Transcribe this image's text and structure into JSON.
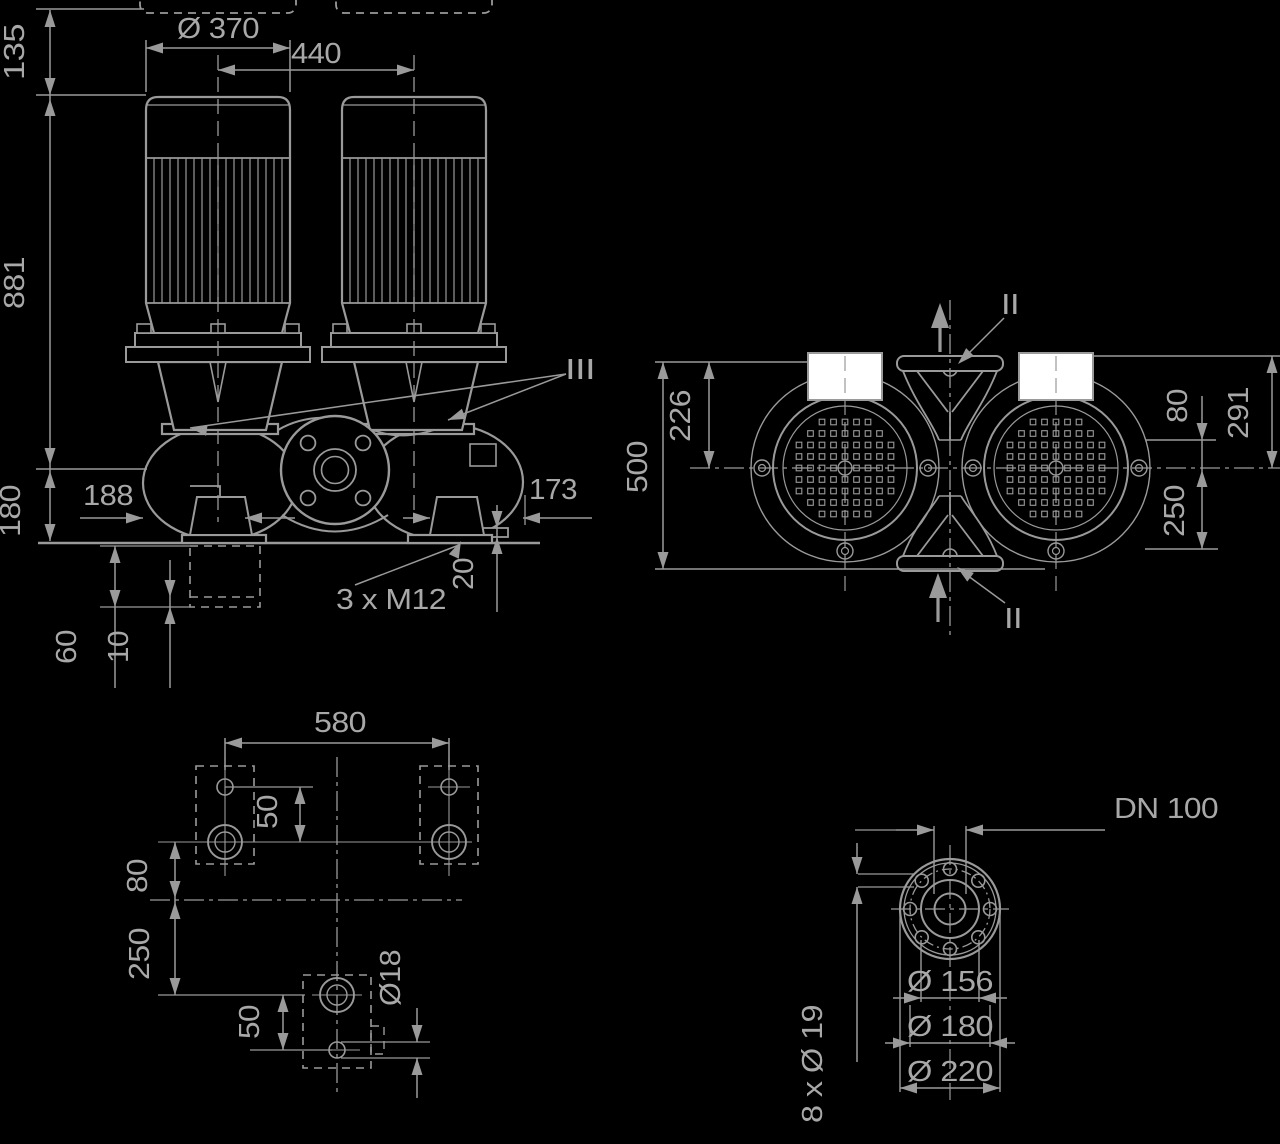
{
  "drawing": {
    "type": "pump-dimensional-drawing",
    "colors": {
      "background": "#000000",
      "line": "#9a9a9a",
      "text": "#a8a8a8",
      "white_fill": "#ffffff"
    },
    "views": {
      "front": {
        "labels": {
          "height_135": "135",
          "motor_dia_370": "Ø 370",
          "motor_spacing_440": "440",
          "height_881": "881",
          "height_180": "180",
          "offset_188": "188",
          "offset_173": "173",
          "pad_20": "20",
          "anchor_bolts": "3 x M12",
          "grout_60": "60",
          "grout_10": "10",
          "section_mark_iii": "III"
        }
      },
      "top": {
        "labels": {
          "depth_500": "500",
          "depth_226": "226",
          "pipe_80": "80",
          "depth_291": "291",
          "depth_250": "250",
          "section_mark_ii_top": "II",
          "section_mark_ii_bottom": "II"
        }
      },
      "foundation": {
        "labels": {
          "span_580": "580",
          "hole_offset_50_top": "50",
          "offset_80": "80",
          "offset_250": "250",
          "hole_offset_50_bottom": "50",
          "hole_dia_18": "Ø18"
        }
      },
      "flange": {
        "labels": {
          "nominal_dn": "DN 100",
          "raised_face_dia": "Ø 156",
          "bolt_circle_dia": "Ø 180",
          "outer_dia": "Ø 220",
          "bolt_holes": "8 x Ø 19"
        }
      }
    }
  }
}
